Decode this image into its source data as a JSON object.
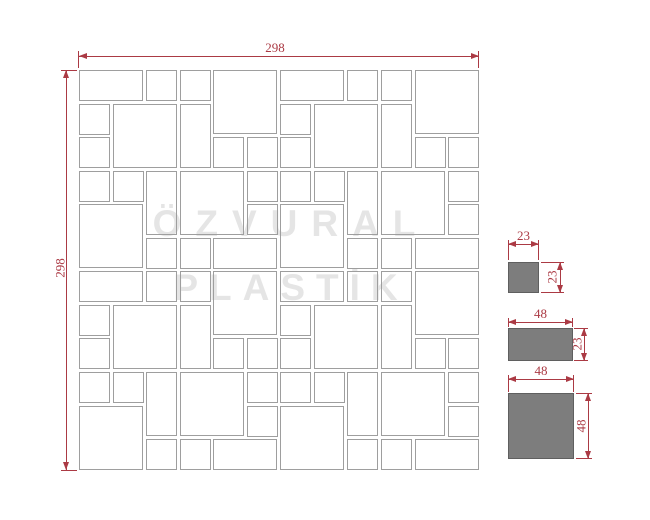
{
  "watermark": {
    "line1": "ÖZVURAL",
    "line2": "PLASTİK"
  },
  "drawing": {
    "width_label": "298",
    "height_label": "298",
    "grid": {
      "unit_mm": 23,
      "joint_mm": 2,
      "cells": 12,
      "overall_mm": 298
    },
    "base_block": {
      "cells": 6,
      "tiles": [
        [
          0,
          0,
          2,
          1
        ],
        [
          2,
          0,
          1,
          1
        ],
        [
          3,
          0,
          1,
          1
        ],
        [
          4,
          0,
          2,
          2
        ],
        [
          0,
          1,
          1,
          1
        ],
        [
          1,
          1,
          2,
          2
        ],
        [
          3,
          1,
          1,
          2
        ],
        [
          0,
          2,
          1,
          1
        ],
        [
          4,
          2,
          1,
          1
        ],
        [
          5,
          2,
          1,
          1
        ],
        [
          0,
          3,
          1,
          1
        ],
        [
          1,
          3,
          1,
          1
        ],
        [
          2,
          3,
          1,
          2
        ],
        [
          3,
          3,
          2,
          2
        ],
        [
          5,
          3,
          1,
          1
        ],
        [
          0,
          4,
          2,
          2
        ],
        [
          5,
          4,
          1,
          1
        ],
        [
          2,
          5,
          1,
          1
        ],
        [
          3,
          5,
          1,
          1
        ],
        [
          4,
          5,
          2,
          1
        ]
      ]
    },
    "block_offsets": [
      [
        0,
        0
      ],
      [
        6,
        0
      ],
      [
        0,
        6
      ],
      [
        6,
        6
      ]
    ]
  },
  "samples": [
    {
      "id": "tile-23x23",
      "width_label": "23",
      "height_label": "23",
      "w_mm": 23,
      "h_mm": 23
    },
    {
      "id": "tile-48x23",
      "width_label": "48",
      "height_label": "23",
      "w_mm": 48,
      "h_mm": 23
    },
    {
      "id": "tile-48x48",
      "width_label": "48",
      "height_label": "48",
      "w_mm": 48,
      "h_mm": 48
    }
  ],
  "colors": {
    "dimension": "#ab3a44",
    "tile_border": "#9e9e9e",
    "sample_fill": "#7d7d7d",
    "sample_border": "#5f5f5f",
    "watermark": "#e5e5e5",
    "background": "#ffffff"
  }
}
